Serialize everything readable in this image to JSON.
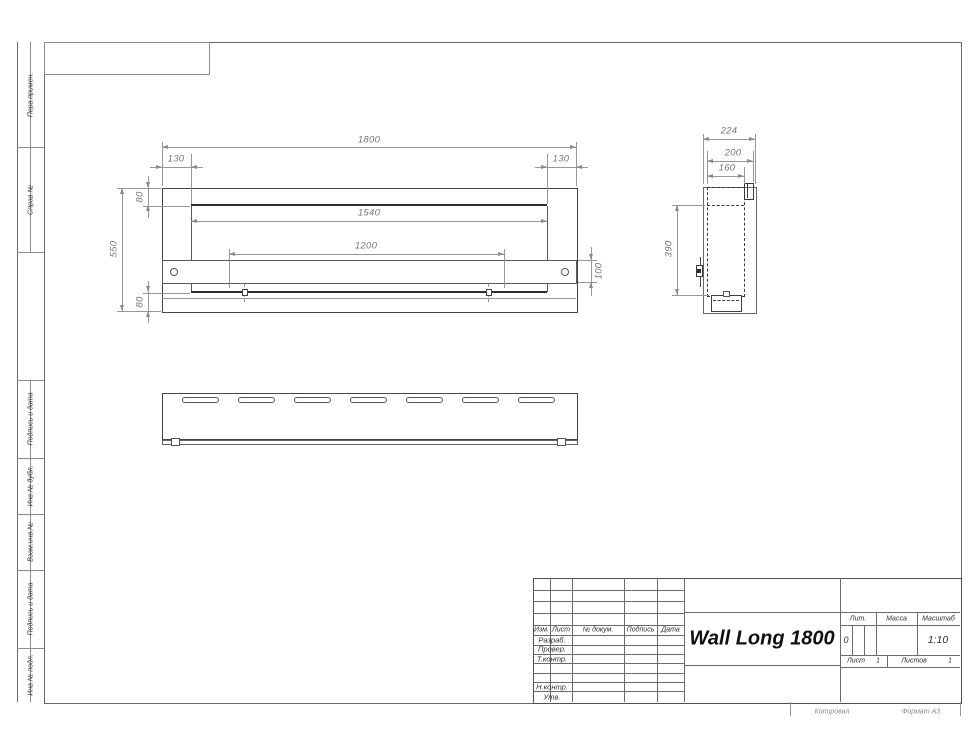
{
  "sheet": {
    "copy_note": "Копировал",
    "format_note": "Формат А3"
  },
  "margin_labels": {
    "perv_primen": "Перв.примен.",
    "sprav_no": "Справ.№",
    "podpis_data_1": "Подпись и дата",
    "inv_dubl": "Инв.№ дубл.",
    "vzam_inv": "Взам.инв.№",
    "podpis_data_2": "Подпись и дата",
    "inv_podl": "Инв.№ подл."
  },
  "views": {
    "front": {
      "dims": {
        "total_width": "1800",
        "left_inset": "130",
        "right_inset": "130",
        "opening_width": "1540",
        "mount_span": "1200",
        "total_height": "550",
        "top_flange": "80",
        "bottom_flange": "80",
        "band_height": "100"
      }
    },
    "side": {
      "dims": {
        "total_depth": "224",
        "body_depth": "200",
        "insert_depth": "160",
        "insert_height": "390"
      }
    }
  },
  "title_block": {
    "doc_title": "Wall Long 1800",
    "header": {
      "izm": "Изм.",
      "list": "Лист",
      "doc_no": "№ докум.",
      "podpis": "Подпись",
      "data": "Дата"
    },
    "roles": {
      "razrab": "Разраб.",
      "prover": "Провер.",
      "tkontr": "Т.контр.",
      "nkontr": "Н.контр.",
      "utv": "Утв."
    },
    "lit": {
      "label": "Лит.",
      "value": "0"
    },
    "massa": {
      "label": "Масса",
      "value": ""
    },
    "scale": {
      "label": "Масштаб",
      "value": "1:10"
    },
    "sheet_no": {
      "label": "Лист",
      "value": "1"
    },
    "sheets_total": {
      "label": "Листов",
      "value": "1"
    }
  }
}
